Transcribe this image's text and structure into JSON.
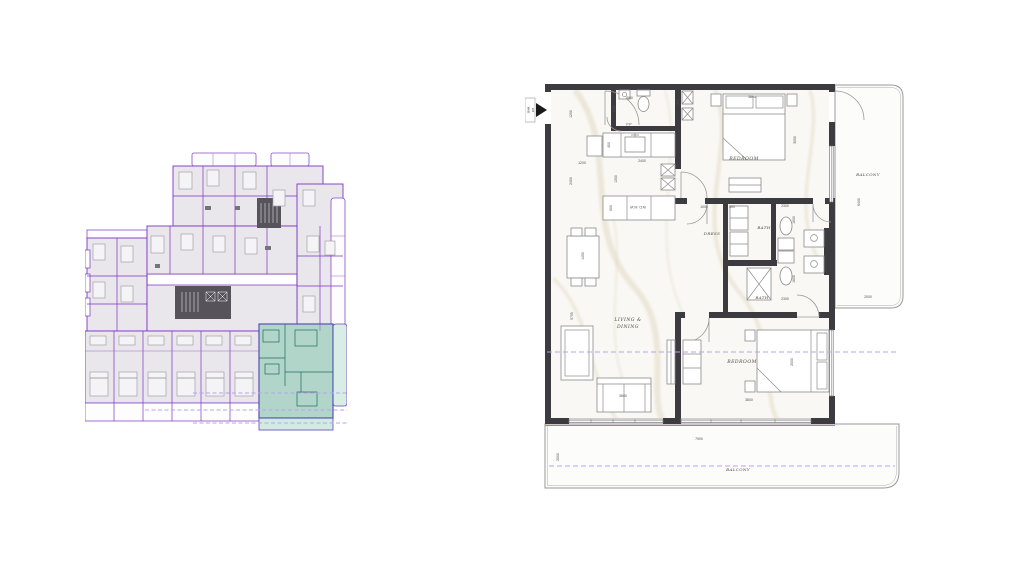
{
  "colors": {
    "wall": "#3C3B40",
    "unit_outline_purple": "#7C35C6",
    "dashed_purple": "#B9A2EC",
    "highlight_teal_fill": "#7AC7A8",
    "highlight_outline_blue": "#2E4D9E",
    "overview_unit_fill": "#E9E6EC",
    "core_fill": "#56535B",
    "floor_fill": "#FAF8F4"
  },
  "unit_plan": {
    "entry_tag": {
      "line1": "2BHK",
      "line2": "305"
    },
    "room_labels": {
      "bedroom_top": "BEDROOM",
      "bedroom_bottom": "BEDROOM",
      "dress": "DRESS",
      "bath_top": "BATH",
      "bath_bottom": "BATH",
      "living_line1": "LIVING &",
      "living_line2": "DINING",
      "balcony_right": "BALCONY",
      "balcony_bottom": "BALCONY",
      "kitchen_units": "W.D. M.W",
      "powder_room": "P.P"
    },
    "dimensions": {
      "hall_top": "1500",
      "shaft": "300",
      "bedroom_top_width": "3800",
      "bedroom_top_depth": "3050",
      "entry_width": "1200",
      "entry_door": "1200",
      "kitchen_clear": "1200",
      "left_wall": "2400",
      "counter_depth": "400",
      "kitchen_width": "2400",
      "kitchen_depth": "1300",
      "utility_depth": "600",
      "dress_width": "1000",
      "closet_width": "500",
      "bath_top_width": "2300",
      "bath_top_depth": "1600",
      "bath_bottom_depth": "1600",
      "bath_bottom_width": "2300",
      "living_length": "5755",
      "dining_table": "1450",
      "sofa_length": "3600",
      "bedroom_bottom_depth": "2000",
      "bedroom_bottom_width": "3800",
      "balcony_right_length": "6400",
      "balcony_right_width": "2000",
      "balcony_bottom_length": "7900",
      "balcony_bottom_depth": "2000"
    }
  }
}
